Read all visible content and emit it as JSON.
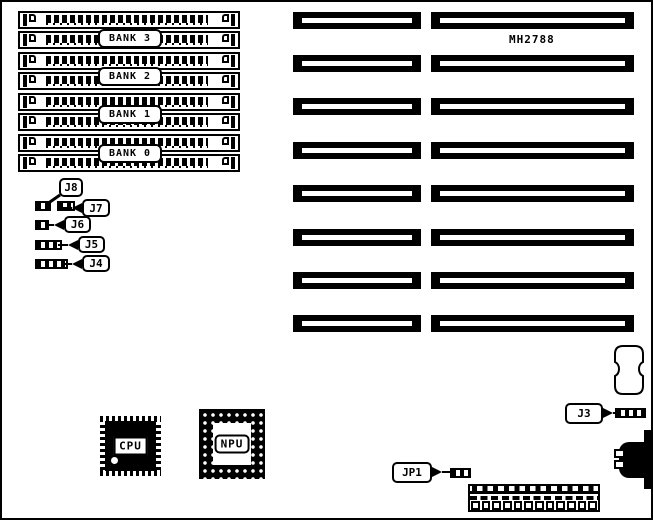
{
  "board": {
    "model_code": "MH2788"
  },
  "memory": {
    "bank_labels": [
      "BANK 3",
      "BANK 2",
      "BANK 1",
      "BANK 0"
    ]
  },
  "jumpers": {
    "j8": "J8",
    "j7": "J7",
    "j6": "J6",
    "j5": "J5",
    "j4": "J4",
    "j3": "J3",
    "jp1": "JP1"
  },
  "chips": {
    "cpu_label": "CPU",
    "npu_label": "NPU"
  },
  "colors": {
    "ink": "#000000",
    "paper": "#ffffff"
  }
}
